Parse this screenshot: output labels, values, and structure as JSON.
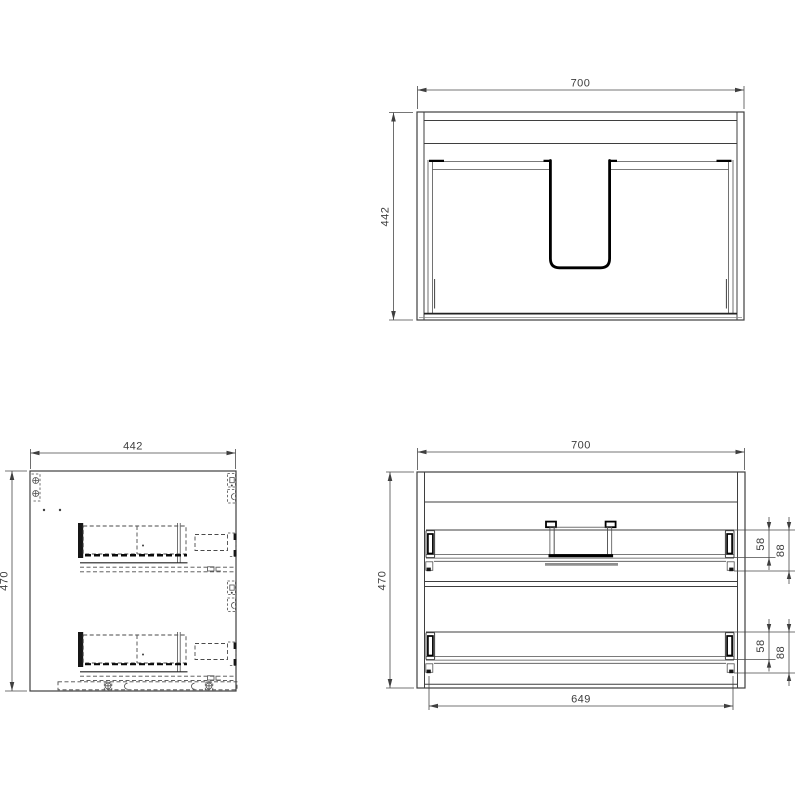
{
  "drawing": {
    "type": "technical-cad-drawing",
    "subject": "two-drawer wall-hung vanity cabinet, three orthographic views",
    "colors": {
      "line": "#3f3f3f",
      "heavy_line": "#000000",
      "hidden_hardware_gray": "#8e8e8e"
    }
  },
  "plan_view": {
    "width": "700",
    "depth": "442"
  },
  "side_view": {
    "width": "442",
    "height": "470"
  },
  "front_view": {
    "width": "700",
    "height": "470",
    "runner_length": "649",
    "upper_drawer": {
      "side_height": "58",
      "total_height": "88"
    },
    "lower_drawer": {
      "side_height": "58",
      "total_height": "88"
    }
  }
}
